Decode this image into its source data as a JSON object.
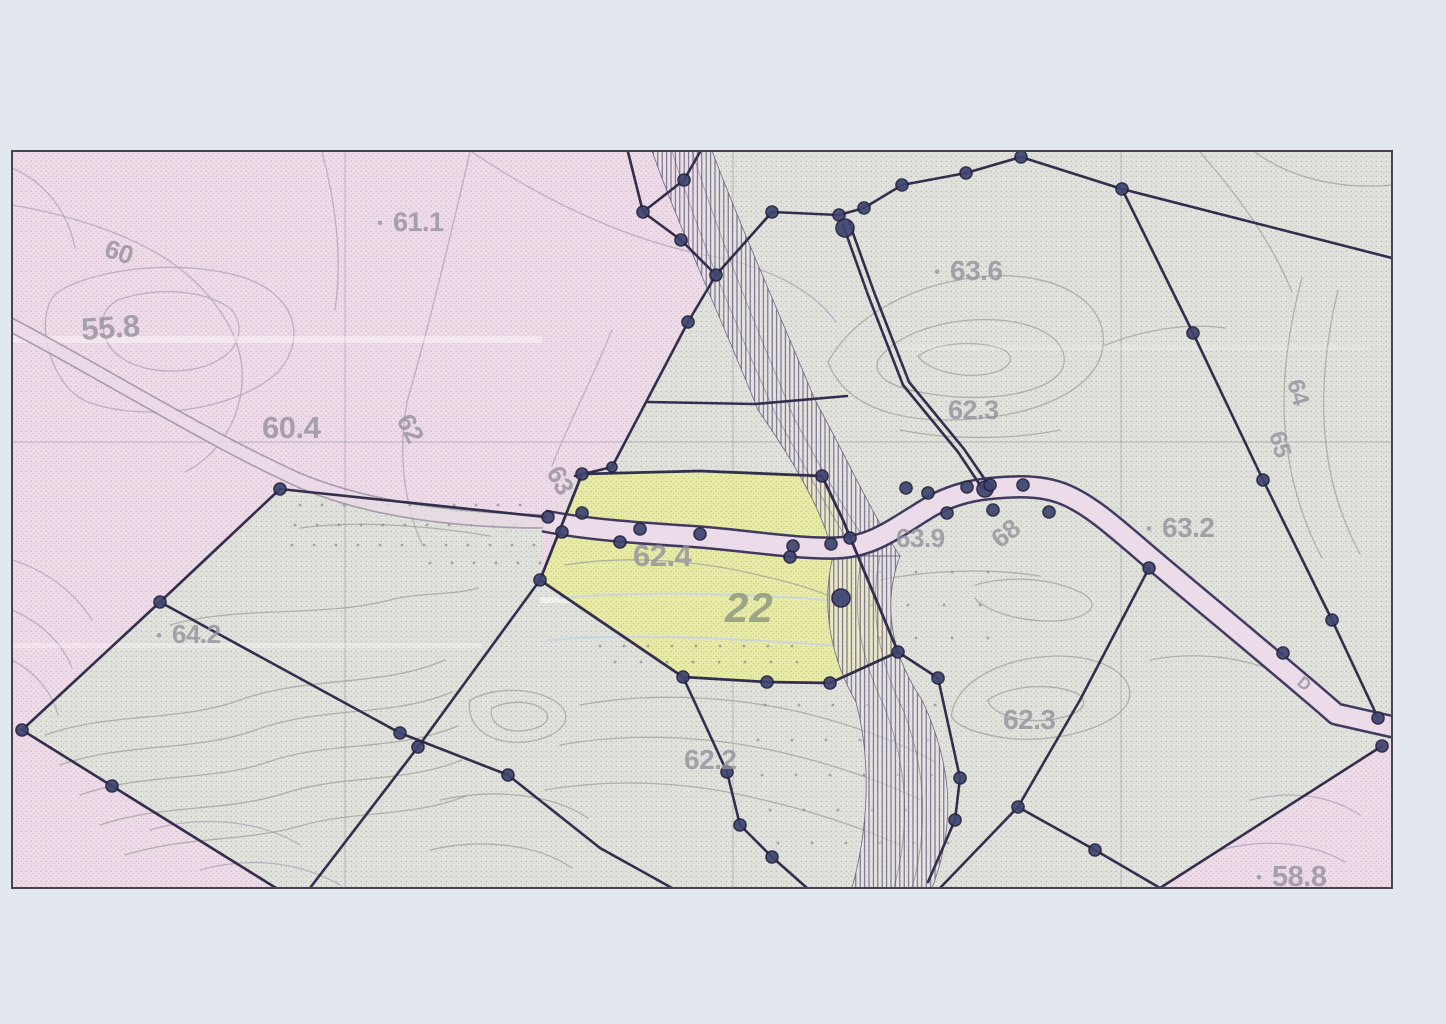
{
  "page": {
    "title": "Scanned cadastral survey map",
    "width": 1446,
    "height": 1024
  },
  "palette": {
    "paper": "#e3e7ee",
    "pink_bg": "#eedce8",
    "pink_dot": "#d9bed4",
    "gray_bg": "#e2e3dd",
    "gray_dot": "#bcbfb8",
    "gray_dot2": "#c9cccf",
    "yellow_bg": "#e9eca4",
    "yellow_dot": "#c9cf74",
    "boundary": "#332e4d",
    "node_fill": "#3d4570",
    "node_ring": "#24213e",
    "road_fill": "#ecdbe8",
    "road_casing": "#37325a",
    "pencil": "#a195a8",
    "pencil_band": "#ead9e6",
    "pinkC": "#b2a4bc",
    "grayC": "#a3a49e",
    "blueC": "#c9d4e4",
    "hatch_line": "#4d4766",
    "hatch_bg": "#ece5ea",
    "hatch_edge": "#5a5472",
    "grid": "#8f96a2",
    "label": "#97939e",
    "label_green": "#8f9a82",
    "frame": "#46444f",
    "dot": "#8e8b98"
  },
  "map": {
    "frame": {
      "x": 12,
      "y": 151,
      "w": 1380,
      "h": 737
    },
    "regions": [
      {
        "name": "region-gray-base",
        "pattern": "gray",
        "d": "M12,151 H1392 V888 H12 Z"
      },
      {
        "name": "region-pink-left",
        "pattern": "pink",
        "d": "M12,151 L700,151 L712,270 L688,322 L648,400 L612,467 L575,476 L540,580 L418,747 L310,888 L12,888 Z"
      },
      {
        "name": "parcel-orchard-strip",
        "pattern": "gray",
        "d": "M280,489 L545,517 L540,580 L418,747 L400,733 L160,602 Z"
      },
      {
        "name": "parcel-gray-southwest",
        "pattern": "gray",
        "d": "M160,602 L400,733 L418,747 L310,888 L276,888 L112,786 L22,730 Z"
      },
      {
        "name": "region-pink-southeast",
        "pattern": "pink",
        "d": "M1392,740 L1392,888 L1160,888 Z"
      }
    ],
    "parcel22": {
      "d": "M582,474 L700,471 L822,476 L843,520 L852,542 L898,652 L830,683 L767,682 L683,677 L540,580 Z",
      "number": "22",
      "elevation": "62.4"
    },
    "grid": {
      "v": [
        345,
        733,
        1121
      ],
      "h": [
        442
      ]
    },
    "contours": [
      {
        "c": "pinkC",
        "d": "M12,205 C70,215 125,233 165,258 C210,288 238,328 242,368 C245,408 225,452 185,472"
      },
      {
        "c": "pinkC",
        "d": "M58,292 C95,268 185,258 245,278 C295,295 308,338 278,372 C235,412 140,422 88,402 C48,386 32,312 58,292 Z"
      },
      {
        "c": "pinkC",
        "d": "M12,168 C45,182 68,212 75,248"
      },
      {
        "c": "pinkC",
        "d": "M118,300 C158,286 208,290 232,310 C247,330 238,354 206,366 C166,378 122,368 108,344 C98,322 103,308 118,300 Z"
      },
      {
        "c": "pinkC",
        "d": "M470,152 C452,230 428,330 408,398 C398,444 402,500 422,544"
      },
      {
        "c": "pinkC",
        "d": "M612,330 C588,388 562,438 552,466"
      },
      {
        "c": "pinkC",
        "d": "M472,152 C540,198 622,238 700,254 C762,264 812,288 836,322"
      },
      {
        "c": "pinkC",
        "d": "M322,152 C335,200 343,258 335,310"
      },
      {
        "c": "pinkC",
        "d": "M12,560 C45,570 75,592 92,620"
      },
      {
        "c": "pinkC",
        "d": "M12,610 C40,622 62,642 72,668"
      },
      {
        "c": "pinkC",
        "d": "M12,660 C35,672 52,692 58,715"
      },
      {
        "c": "pinkC",
        "d": "M150,830 C200,815 260,820 300,845"
      },
      {
        "c": "pinkC",
        "d": "M200,870 C250,856 300,862 340,885"
      },
      {
        "c": "pinkC",
        "d": "M1250,800 C1290,790 1330,795 1360,815"
      },
      {
        "c": "pinkC",
        "d": "M1220,850 C1265,838 1310,842 1345,862"
      },
      {
        "c": "grayC",
        "d": "M45,735 C110,712 180,722 240,700 C310,675 380,688 445,660"
      },
      {
        "c": "grayC",
        "d": "M60,765 C125,742 195,752 255,730 C325,705 390,718 452,692"
      },
      {
        "c": "grayC",
        "d": "M80,795 C145,772 210,782 268,762 C332,740 395,752 458,726"
      },
      {
        "c": "grayC",
        "d": "M100,825 C162,804 225,812 282,794 C342,774 402,784 462,760"
      },
      {
        "c": "grayC",
        "d": "M125,855 C185,836 245,842 300,826 C355,810 410,818 466,796"
      },
      {
        "c": "grayC",
        "d": "M170,625 C240,605 320,618 390,600 C420,592 450,596 478,588"
      },
      {
        "c": "grayC",
        "d": "M300,528 C360,520 430,526 490,536"
      },
      {
        "c": "grayC",
        "d": "M828,362 C856,312 918,282 988,276 C1058,272 1108,302 1103,346 C1098,392 1028,420 948,420 C888,420 843,402 828,362 Z"
      },
      {
        "c": "grayC",
        "d": "M878,360 C898,332 948,317 998,320 C1048,324 1072,346 1062,370 C1047,394 988,402 938,395 C898,390 872,380 878,360 Z"
      },
      {
        "c": "grayC",
        "d": "M918,356 C938,342 976,340 1002,349 C1017,356 1012,369 988,374 C958,379 926,369 918,356 Z"
      },
      {
        "c": "grayC",
        "d": "M1103,346 C1140,331 1185,322 1225,328"
      },
      {
        "c": "grayC",
        "d": "M1200,152 C1235,192 1272,242 1292,292"
      },
      {
        "c": "grayC",
        "d": "M1255,152 C1290,178 1340,190 1392,185"
      },
      {
        "c": "grayC",
        "d": "M1302,278 C1288,330 1280,388 1286,438 C1290,478 1302,520 1322,558"
      },
      {
        "c": "grayC",
        "d": "M1338,290 C1326,340 1320,395 1326,444 C1330,482 1342,520 1360,554"
      },
      {
        "c": "grayC",
        "d": "M900,430 C950,440 1010,440 1060,430"
      },
      {
        "c": "grayC",
        "d": "M952,712 C958,682 1000,658 1055,656 C1105,655 1138,678 1128,702 C1115,728 1055,744 1005,738 C968,732 948,722 952,712 Z"
      },
      {
        "c": "grayC",
        "d": "M988,700 C1010,685 1052,682 1078,694 C1092,704 1080,716 1048,720 C1016,723 990,712 988,700 Z"
      },
      {
        "c": "grayC",
        "d": "M1150,660 C1200,650 1255,658 1298,682"
      },
      {
        "c": "grayC",
        "d": "M580,705 C650,692 730,696 800,712 C850,724 900,742 935,762"
      },
      {
        "c": "grayC",
        "d": "M560,745 C630,732 710,736 780,752 C835,765 885,782 920,800"
      },
      {
        "c": "grayC",
        "d": "M545,790 C615,778 690,782 755,798 C810,810 862,828 900,845"
      },
      {
        "c": "grayC",
        "d": "M440,800 C495,788 552,794 588,818"
      },
      {
        "c": "grayC",
        "d": "M430,850 C480,838 538,844 572,868"
      },
      {
        "c": "grayC",
        "d": "M470,700 C500,685 540,688 560,705 C575,720 560,738 525,742 C492,745 465,728 470,700 Z"
      },
      {
        "c": "grayC",
        "d": "M492,708 C512,699 535,701 546,712 C552,722 540,730 518,731 C500,731 488,720 492,708 Z"
      },
      {
        "c": "grayC",
        "d": "M880,580 C930,570 990,568 1040,576"
      },
      {
        "c": "grayC",
        "d": "M975,585 C1010,575 1050,578 1080,592 C1100,602 1095,615 1065,620 C1030,625 985,612 975,598"
      },
      {
        "c": "blueC",
        "w": 2,
        "o": 0.9,
        "d": "M560,598 C650,590 755,594 855,602"
      },
      {
        "c": "blueC",
        "w": 2,
        "o": 0.9,
        "d": "M548,640 C640,632 755,640 842,646"
      },
      {
        "c": "grayC",
        "d": "M565,565 C625,555 700,560 762,576 C805,585 832,596 852,606"
      }
    ],
    "streaks": [
      [
        12,
        336,
        530,
        7,
        0.4
      ],
      [
        540,
        597,
        330,
        6,
        0.5
      ],
      [
        12,
        643,
        470,
        5,
        0.3
      ],
      [
        900,
        345,
        470,
        5,
        0.18
      ]
    ],
    "dot_rows": [
      [
        505,
        300,
        530,
        22
      ],
      [
        525,
        295,
        535,
        22
      ],
      [
        545,
        292,
        538,
        22
      ],
      [
        563,
        430,
        540,
        22
      ],
      [
        646,
        600,
        800,
        24
      ],
      [
        662,
        615,
        810,
        26
      ],
      [
        572,
        880,
        1000,
        36
      ],
      [
        605,
        872,
        1008,
        36
      ],
      [
        638,
        880,
        1000,
        36
      ],
      [
        705,
        765,
        935,
        34
      ],
      [
        740,
        758,
        940,
        34
      ],
      [
        775,
        762,
        945,
        34
      ],
      [
        810,
        770,
        950,
        34
      ],
      [
        843,
        778,
        952,
        34
      ]
    ],
    "hatch": {
      "strips": [
        {
          "name": "hatch-strip-north",
          "d": "M652,151 L712,151 C742,230 782,320 815,400 C848,460 872,515 900,556 L833,556 C826,520 800,470 758,410 C722,320 680,230 652,151 Z"
        },
        {
          "name": "hatch-strip-south",
          "d": "M833,556 L900,556 C880,610 895,660 922,700 C950,760 958,820 932,888 L852,888 C868,830 872,762 856,702 C832,660 820,608 833,556 Z"
        }
      ],
      "flow_lines": [
        "M672,151 C700,240 738,330 776,415 C804,465 830,515 856,552",
        "M692,151 C720,240 758,332 794,418 C820,466 846,514 872,550",
        "M862,556 C850,610 862,660 884,706 C906,762 912,820 894,888",
        "M880,556 C868,612 880,664 904,712 C924,766 930,822 912,888"
      ]
    },
    "road_left": {
      "band": "M12,326 C100,372 212,442 302,482 C380,514 470,521 545,522",
      "lines": [
        "M12,318 C100,364 212,434 302,474 C380,506 472,513 546,515",
        "M12,333 C100,379 212,449 302,489 C380,521 470,528 544,528"
      ]
    },
    "road_main": {
      "d": "M544,521 C590,530 640,533 700,537 C750,541 795,549 836,548 C872,547 892,530 930,507 C958,491 985,488 1012,487 C1034,486 1052,489 1066,495 C1094,507 1120,532 1158,564 C1215,612 1288,672 1336,714 L1398,728",
      "width": 18.5,
      "casing": 23.5
    },
    "boundaries": [
      "628,152 643,212",
      "700,152 684,180 643,212 681,240 716,275 688,322 612,467 575,476",
      "716,275 772,212 839,215 864,208 902,185 966,173 1021,157",
      "1021,157 1122,189 1193,333 1263,480 1332,620 1378,718",
      "1122,189 1392,258",
      "843,225 868,295 903,385 958,452 982,488",
      "849,222 874,292 909,382 964,449 988,484",
      "648,402 755,404 847,396",
      "280,489 545,517",
      "280,489 160,602",
      "160,602 400,733 508,775 600,848 672,888",
      "540,580 418,747 310,888",
      "22,730 160,602",
      "22,730 112,786 276,888",
      "683,677 727,772 740,825 772,857 807,888",
      "898,652 938,678 960,778 955,820 928,882",
      "1149,568 1080,700 1018,807 940,888",
      "1018,807 1095,850 1160,888",
      "1382,746 1160,888"
    ],
    "nodes": [
      [
        684,
        180
      ],
      [
        643,
        212
      ],
      [
        681,
        240
      ],
      [
        716,
        275
      ],
      [
        688,
        322
      ],
      [
        612,
        467,
        5
      ],
      [
        772,
        212
      ],
      [
        839,
        215
      ],
      [
        864,
        208
      ],
      [
        902,
        185
      ],
      [
        966,
        173
      ],
      [
        1021,
        157
      ],
      [
        1122,
        189
      ],
      [
        1193,
        333
      ],
      [
        1263,
        480
      ],
      [
        1332,
        620
      ],
      [
        1378,
        718
      ],
      [
        1382,
        746
      ],
      [
        845,
        228,
        9
      ],
      [
        985,
        489,
        8
      ],
      [
        582,
        474
      ],
      [
        822,
        476
      ],
      [
        850,
        538
      ],
      [
        841,
        598,
        9
      ],
      [
        898,
        652
      ],
      [
        830,
        683
      ],
      [
        767,
        682
      ],
      [
        683,
        677
      ],
      [
        540,
        580
      ],
      [
        548,
        517
      ],
      [
        582,
        513
      ],
      [
        640,
        529
      ],
      [
        700,
        534
      ],
      [
        793,
        546
      ],
      [
        831,
        544
      ],
      [
        562,
        532
      ],
      [
        620,
        542
      ],
      [
        790,
        557
      ],
      [
        906,
        488
      ],
      [
        928,
        493
      ],
      [
        967,
        487
      ],
      [
        990,
        485
      ],
      [
        1023,
        485
      ],
      [
        947,
        513
      ],
      [
        993,
        510
      ],
      [
        1049,
        512
      ],
      [
        1149,
        568
      ],
      [
        1283,
        653
      ],
      [
        280,
        489
      ],
      [
        160,
        602
      ],
      [
        22,
        730
      ],
      [
        112,
        786
      ],
      [
        400,
        733
      ],
      [
        418,
        747
      ],
      [
        508,
        775
      ],
      [
        727,
        772
      ],
      [
        740,
        825
      ],
      [
        772,
        857
      ],
      [
        938,
        678
      ],
      [
        960,
        778
      ],
      [
        955,
        820
      ],
      [
        1018,
        807
      ],
      [
        1095,
        850
      ]
    ],
    "labels": [
      {
        "t": "60",
        "x": 103,
        "y": 256,
        "s": 26,
        "r": 18
      },
      {
        "t": "55.8",
        "x": 82,
        "y": 340,
        "s": 31,
        "r": -4
      },
      {
        "t": "60.4",
        "x": 262,
        "y": 438,
        "s": 31,
        "r": 0
      },
      {
        "t": "61.1",
        "x": 393,
        "y": 231,
        "s": 27,
        "r": 0,
        "dot": 1
      },
      {
        "t": "62",
        "x": 396,
        "y": 420,
        "s": 26,
        "r": 62
      },
      {
        "t": "63",
        "x": 546,
        "y": 472,
        "s": 26,
        "r": 62
      },
      {
        "t": "63.6",
        "x": 950,
        "y": 280,
        "s": 28,
        "r": 0,
        "dot": 1
      },
      {
        "t": "62.3",
        "x": 948,
        "y": 419,
        "s": 27,
        "r": 0
      },
      {
        "t": "63.2",
        "x": 1162,
        "y": 537,
        "s": 28,
        "r": 0,
        "dot": 1
      },
      {
        "t": "62.4",
        "x": 633,
        "y": 566,
        "s": 31,
        "r": 0
      },
      {
        "t": "22",
        "x": 725,
        "y": 622,
        "s": 42,
        "r": 0,
        "k": "num"
      },
      {
        "t": "63.9",
        "x": 896,
        "y": 547,
        "s": 26,
        "r": 0
      },
      {
        "t": "68",
        "x": 1000,
        "y": 549,
        "s": 26,
        "r": -38
      },
      {
        "t": "64.2",
        "x": 172,
        "y": 643,
        "s": 26,
        "r": 0,
        "dot": 1
      },
      {
        "t": "62.3",
        "x": 1003,
        "y": 729,
        "s": 28,
        "r": 0
      },
      {
        "t": "62.2",
        "x": 684,
        "y": 769,
        "s": 28,
        "r": 0
      },
      {
        "t": "58.8",
        "x": 1272,
        "y": 886,
        "s": 29,
        "r": 0,
        "dot": 1
      },
      {
        "t": "64",
        "x": 1287,
        "y": 382,
        "s": 24,
        "r": 74
      },
      {
        "t": "65",
        "x": 1269,
        "y": 434,
        "s": 24,
        "r": 74
      },
      {
        "t": "D",
        "x": 1296,
        "y": 684,
        "s": 17,
        "r": 40
      }
    ]
  }
}
